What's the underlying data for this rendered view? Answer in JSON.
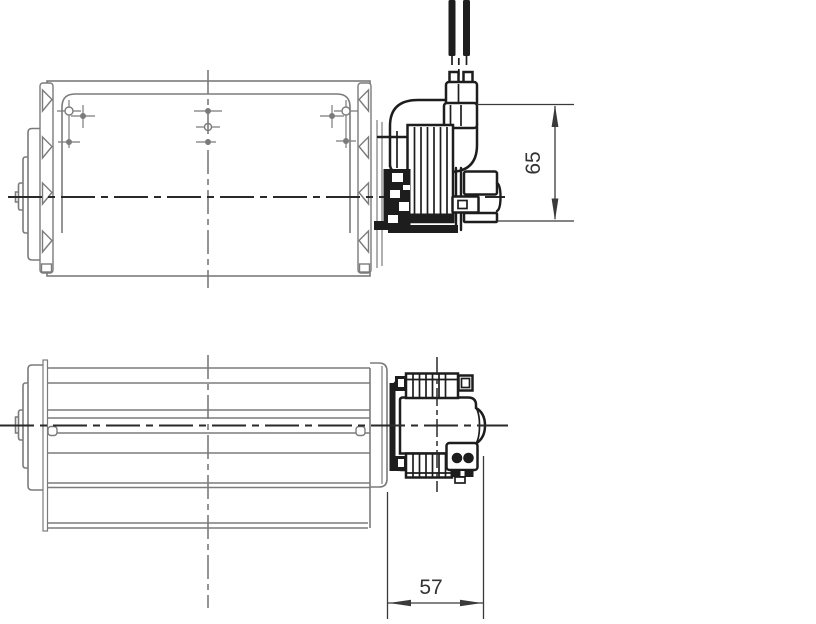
{
  "drawing": {
    "type": "engineering-drawing",
    "subject": "tangential cross-flow blower with motor, two orthographic views"
  },
  "dimensions": {
    "motor_height": {
      "value": "65"
    },
    "motor_depth": {
      "value": "57"
    }
  },
  "colors": {
    "background": "#ffffff",
    "housing_line": "#7b7b7b",
    "motor_line": "#1d1d1d",
    "centerline": "#2a2a2a",
    "dimension_line": "#3a3a3a",
    "text_color": "#333333"
  }
}
